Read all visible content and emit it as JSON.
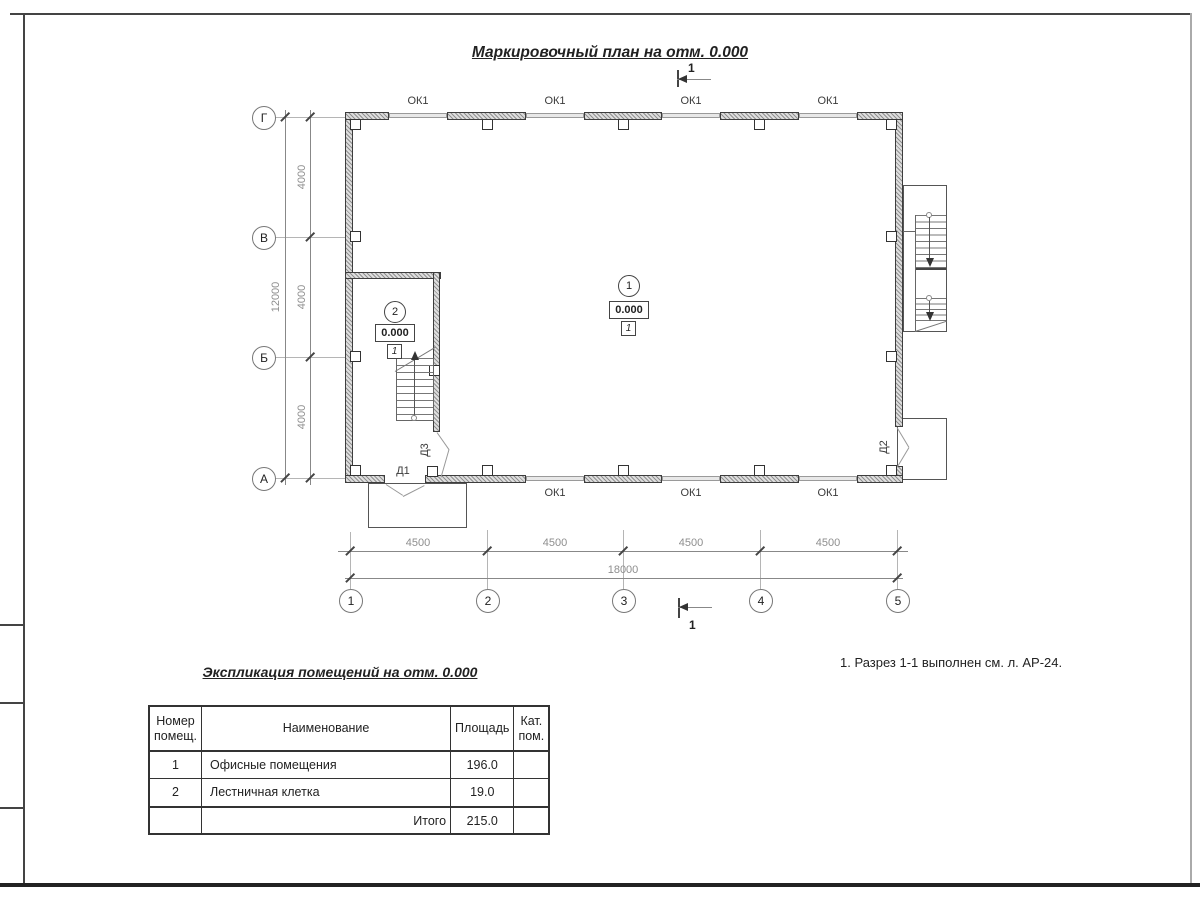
{
  "title": "Маркировочный план на отм. 0.000",
  "note": "1. Разрез 1-1 выполнен см. л. АР-24.",
  "section_mark": "1",
  "plan": {
    "windows_top": [
      "ОК1",
      "ОК1",
      "ОК1",
      "ОК1"
    ],
    "windows_bottom": [
      "ОК1",
      "ОК1",
      "ОК1"
    ],
    "doors": {
      "d1": "Д1",
      "d2": "Д2",
      "d3": "Д3"
    },
    "rooms": [
      {
        "number": "1",
        "elevation": "0.000",
        "category_mark": "1"
      },
      {
        "number": "2",
        "elevation": "0.000",
        "category_mark": "1"
      }
    ],
    "axes_bottom": [
      "1",
      "2",
      "3",
      "4",
      "5"
    ],
    "axes_left": [
      "Г",
      "В",
      "Б",
      "А"
    ],
    "dims_bottom": [
      "4500",
      "4500",
      "4500",
      "4500"
    ],
    "dim_bottom_total": "18000",
    "dims_left": [
      "4000",
      "4000",
      "4000"
    ],
    "dim_left_total": "12000"
  },
  "table": {
    "title": "Экспликация помещений на отм. 0.000",
    "col_headers": [
      "Номер помещ.",
      "Наименование",
      "Площадь",
      "Кат. пом."
    ],
    "rows": [
      {
        "num": "1",
        "name": "Офисные помещения",
        "area": "196.0",
        "cat": ""
      },
      {
        "num": "2",
        "name": "Лестничная клетка",
        "area": "19.0",
        "cat": ""
      }
    ],
    "total_label": "Итого",
    "total_value": "215.0"
  }
}
